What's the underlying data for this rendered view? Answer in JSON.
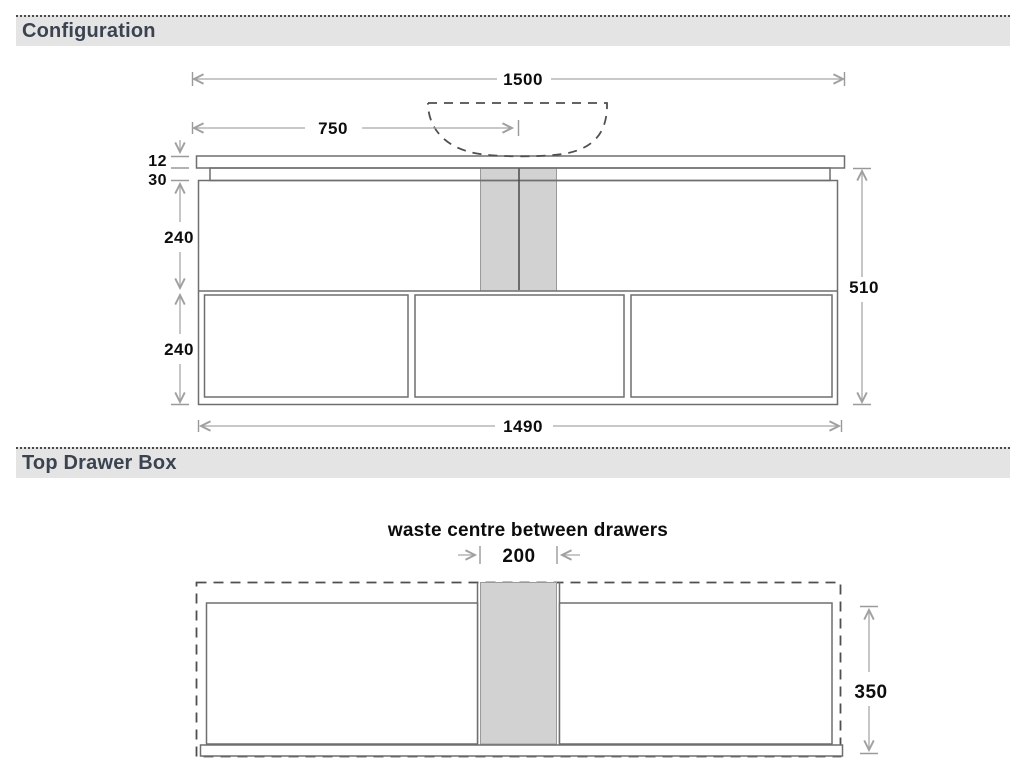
{
  "sections": {
    "configuration": {
      "title": "Configuration"
    },
    "top_drawer_box": {
      "title": "Top Drawer Box"
    }
  },
  "configuration": {
    "dims": {
      "overall_width": "1500",
      "basin_centre": "750",
      "benchtop_thickness": "12",
      "top_gap": "30",
      "top_drawer_height": "240",
      "bottom_drawer_height": "240",
      "total_height": "510",
      "cabinet_width": "1490"
    }
  },
  "top_drawer_box": {
    "caption": "waste centre between drawers",
    "dims": {
      "waste_centre_width": "200",
      "drawer_box_depth": "350"
    }
  },
  "colors": {
    "header_bg": "#e4e4e4",
    "header_text": "#3b4350",
    "structure_line": "#6f6f6f",
    "dimension_line": "#a8a8a8",
    "dashed_line": "#4f4f4f",
    "waste_fill": "#d2d2d2",
    "label_text": "#0d0d0d"
  }
}
